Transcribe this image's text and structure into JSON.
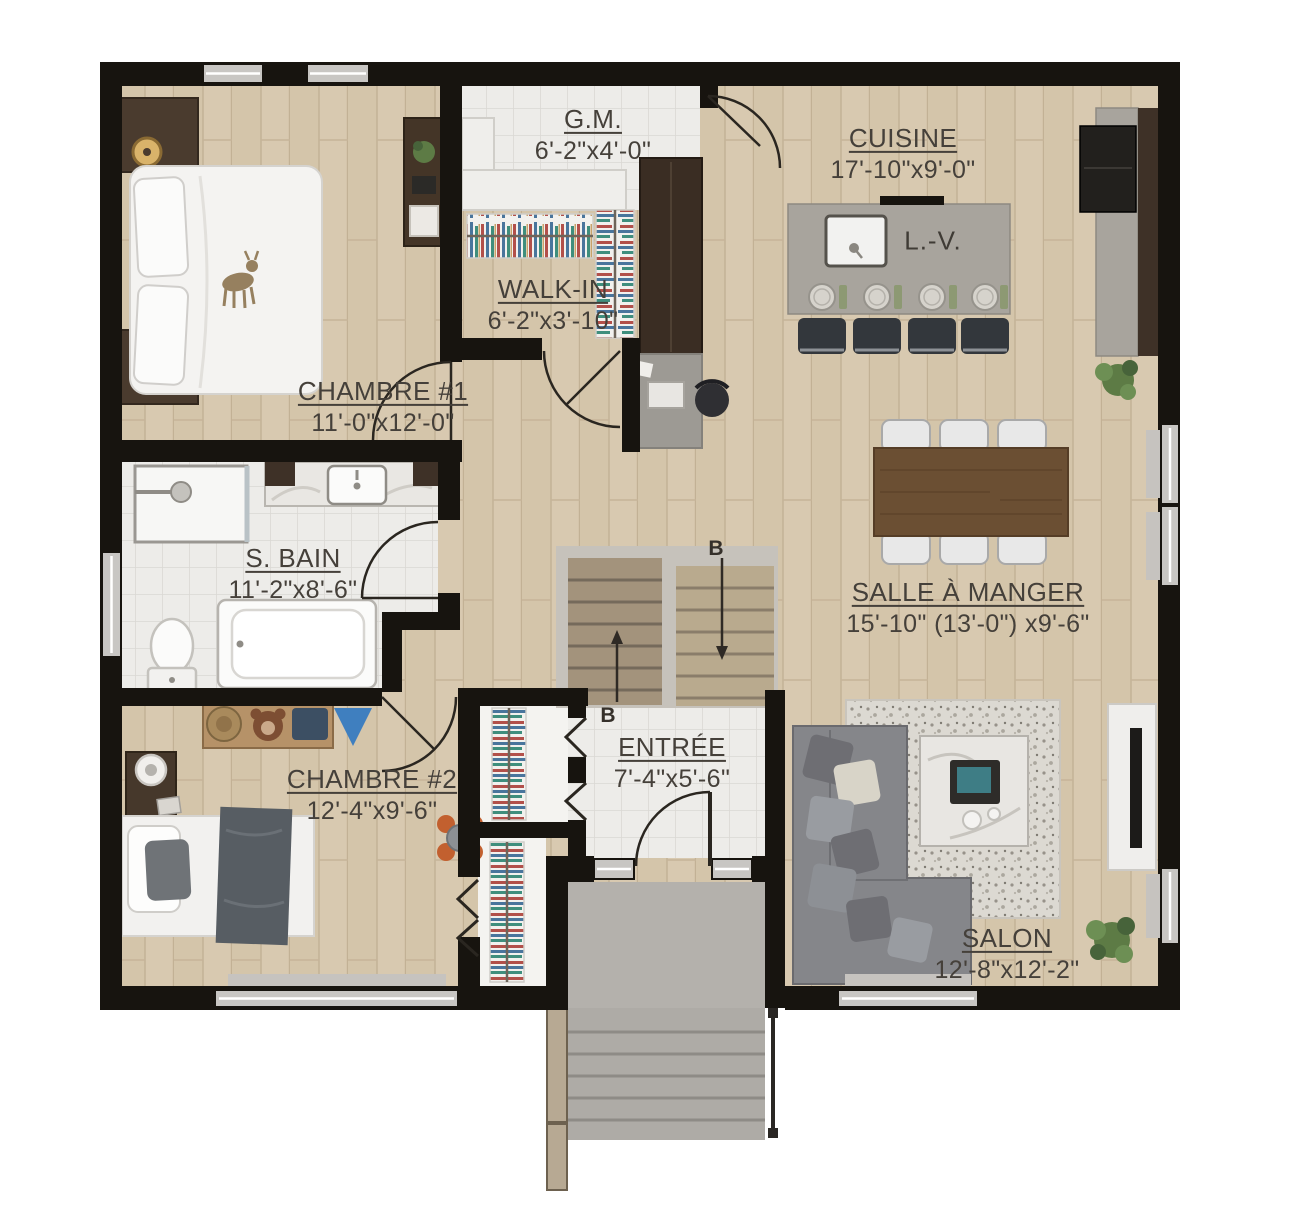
{
  "rooms": [
    {
      "id": "gm",
      "name": "G.M.",
      "dims": "6'-2\"x4'-0\""
    },
    {
      "id": "cuisine",
      "name": "CUISINE",
      "dims": "17'-10\"x9'-0\""
    },
    {
      "id": "walkin",
      "name": "WALK-IN",
      "dims": "6'-2\"x3'-10\""
    },
    {
      "id": "chambre1",
      "name": "CHAMBRE #1",
      "dims": "11'-0\"x12'-0\""
    },
    {
      "id": "sbain",
      "name": "S. BAIN",
      "dims": "11'-2\"x8'-6\""
    },
    {
      "id": "salle_a_manger",
      "name": "SALLE À MANGER",
      "dims": "15'-10\" (13'-0\") x9'-6\""
    },
    {
      "id": "entree",
      "name": "ENTRÉE",
      "dims": "7'-4\"x5'-6\""
    },
    {
      "id": "chambre2",
      "name": "CHAMBRE #2",
      "dims": "12'-4\"x9'-6\""
    },
    {
      "id": "salon",
      "name": "SALON",
      "dims": "12'-8\"x12'-2\""
    }
  ],
  "annotations": {
    "dishwasher": "L.-V.",
    "section_b_top": "B",
    "section_b_bottom": "B"
  },
  "palette": {
    "wall": "#17140f",
    "wood_floor": "#d8c9b0",
    "tile_floor": "#edece9",
    "label_text": "#45403a",
    "island_gray": "#a8a49d",
    "cabinet_brown": "#3e3127",
    "sofa_gray": "#808084",
    "table_wood": "#6b4f33",
    "plant_green": "#5d7b45",
    "concrete": "#b2afaa"
  }
}
